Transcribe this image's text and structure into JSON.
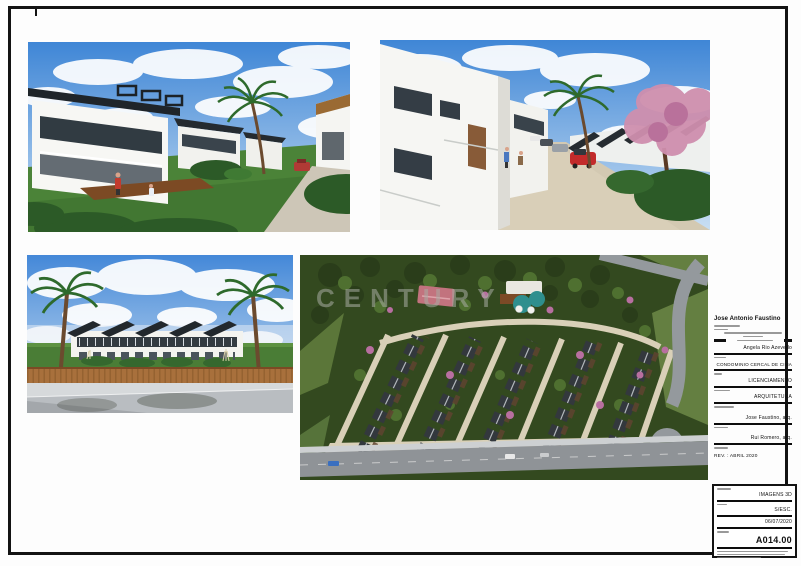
{
  "watermark": "CENTURY",
  "title_block": {
    "name": "Jose Antonio Faustino",
    "fields": [
      {
        "value": "Angela Rio Azevedo"
      },
      {
        "value": "CONDOMINIO CERCAL DE CIMA"
      },
      {
        "value": "LICENCIAMENTO"
      },
      {
        "value": "ARQUITETURA"
      },
      {
        "value": "Jose Faustino, arq."
      },
      {
        "value": "Rui Romero, arq."
      }
    ],
    "revision": "REV. : ABRIL 2020"
  },
  "sheet_block": {
    "drawing_title": "IMAGENS 3D",
    "scale": "S/ESC.",
    "date": "06/07/2020",
    "sheet_number": "A014.00"
  }
}
